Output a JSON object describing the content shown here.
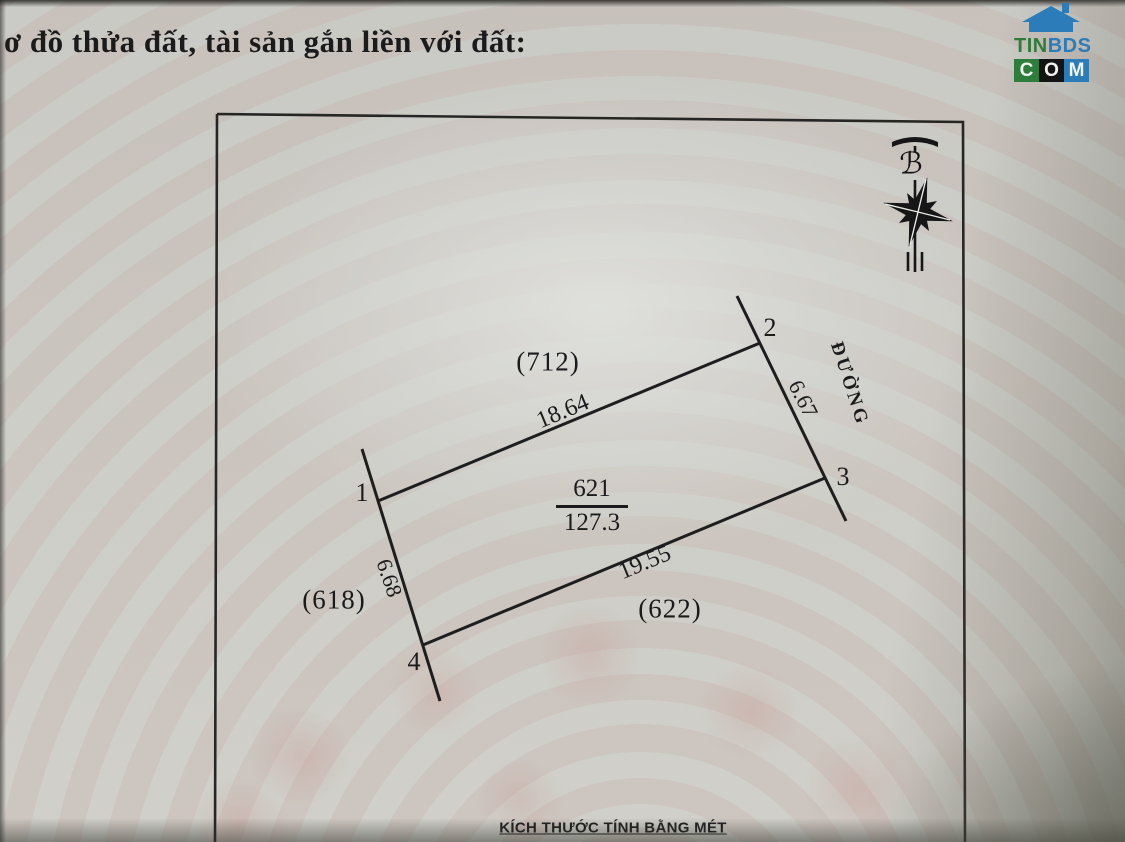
{
  "title": "ơ đồ thửa đất, tài sản gắn liền với đất:",
  "logo": {
    "brand_top_green": "TIN",
    "brand_top_blue": "BDS",
    "brand_bottom": [
      "C",
      "O",
      "M"
    ],
    "colors": {
      "blue": "#2b7cb9",
      "green": "#2f7d3b",
      "black": "#141414"
    }
  },
  "diagram": {
    "north_symbol": "ℬ",
    "road_label": "ĐƯỜNG",
    "plot_number": "621",
    "plot_area": "127.3",
    "corners": [
      "1",
      "2",
      "3",
      "4"
    ],
    "dimensions": {
      "top": "18.64",
      "right": "6.67",
      "bottom": "19.55",
      "left": "6.68"
    },
    "neighbors": {
      "top": "(712)",
      "left": "(618)",
      "bottom": "(622)"
    },
    "footer_note": "KÍCH THƯỚC TÍNH BẰNG MÉT"
  }
}
